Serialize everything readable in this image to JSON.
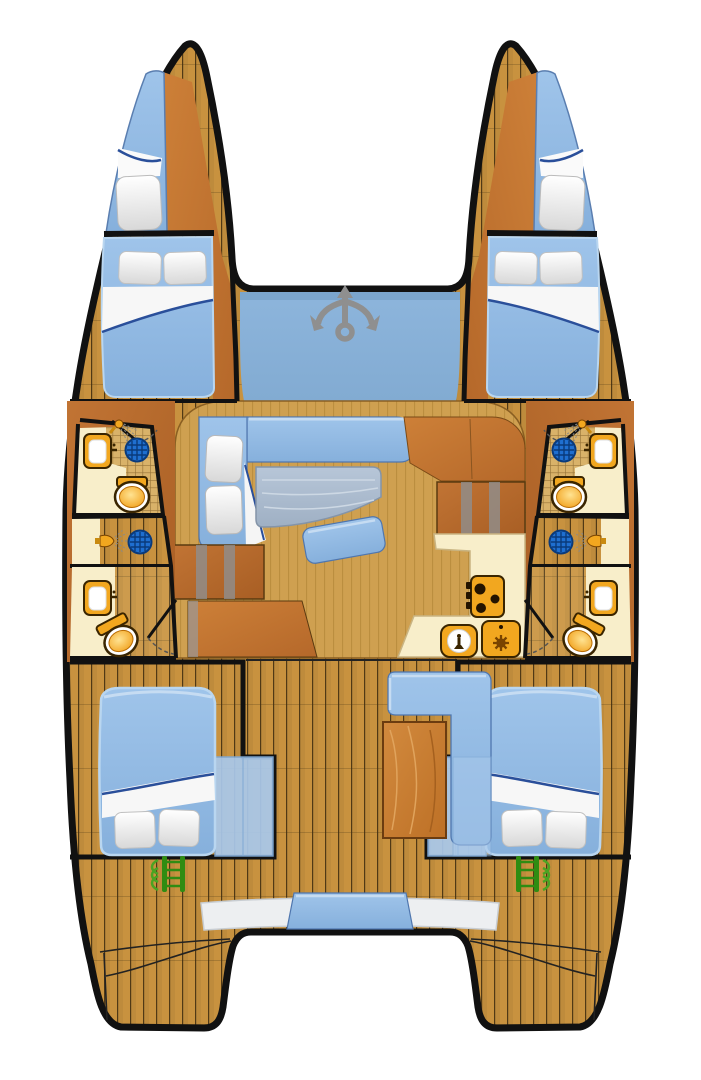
{
  "diagram": {
    "type": "catamaran-deck-plan",
    "view": "top-down",
    "orientation": "bow-up"
  },
  "colors": {
    "background": "#ffffff",
    "hull_outline": "#111111",
    "deck_wood": "#c8923f",
    "plank_line": "#3d2a0e",
    "furniture_wood": "#cd8038",
    "furniture_wood_dark": "#b5682a",
    "side_wood": "#c17434",
    "side_wood_dark": "#a85e24",
    "table_wood": "#d28a3e",
    "salon_floor": "#cfa050",
    "salon_stripe": "#a87c2e",
    "cushion_blue": "#93bde6",
    "cushion_blue_deep": "#86b0dc",
    "cushion_blue_light": "#c6dcf2",
    "cushion_edge": "#4f76ae",
    "bench_translucent": "#a9c9ec",
    "trampoline_blue": "#8db5dc",
    "anchor_gray": "#8f8f8f",
    "pillow_white": "#ffffff",
    "pillow_shade": "#d8d8d8",
    "sheet_fold_navy": "#2a4f9a",
    "counter_cream": "#f8eeca",
    "fixture_orange": "#f2a71f",
    "fixture_outline": "#3a2500",
    "toilet_bowl_light": "#ffe392",
    "toilet_bowl_deep": "#f09b12",
    "tile_base": "#d9b269",
    "tile_line": "#8f6d33",
    "drain_blue": "#1f6fd0",
    "drain_line": "#0a3a7a",
    "ladder_green": "#2f8c12",
    "ladder_leaf_green": "#4aa322",
    "table_gray_light": "#b7c6d8",
    "table_gray_deep": "#9fb0c4",
    "transom_bench_white": "#edeff1",
    "spray_gray": "#8a8a8a"
  },
  "icons": [
    {
      "name": "anchor-icon",
      "meaning": "foredeck anchor / windlass"
    },
    {
      "name": "shower-head-icon",
      "meaning": "shower"
    },
    {
      "name": "drain-icon",
      "meaning": "shower drain"
    },
    {
      "name": "toilet-icon",
      "meaning": "marine toilet"
    },
    {
      "name": "sink-icon",
      "meaning": "wash basin"
    },
    {
      "name": "stove-icon",
      "meaning": "galley stove with burners"
    },
    {
      "name": "galley-sink-icon",
      "meaning": "galley sink"
    },
    {
      "name": "appliance-icon",
      "meaning": "galley appliance"
    },
    {
      "name": "ladder-icon",
      "meaning": "stern boarding steps"
    }
  ]
}
